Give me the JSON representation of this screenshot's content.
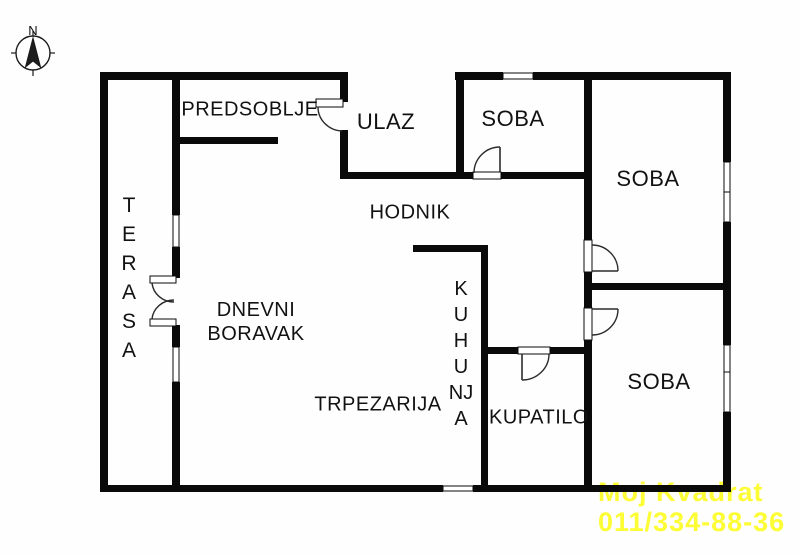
{
  "compass": {
    "north_label": "N"
  },
  "rooms": {
    "predsoblje": "PREDSOBLJE",
    "ulaz": "ULAZ",
    "soba_top": "SOBA",
    "soba_right_upper": "SOBA",
    "soba_right_lower": "SOBA",
    "hodnik": "HODNIK",
    "dnevni_line1": "DNEVNI",
    "dnevni_line2": "BORAVAK",
    "trpezarija": "TRPEZARIJA",
    "kupatilo": "KUPATILO",
    "terasa_letters": [
      "T",
      "E",
      "R",
      "A",
      "S",
      "A"
    ],
    "kuhinja_letters": [
      "K",
      "U",
      "H",
      "U",
      "NJ",
      "A"
    ]
  },
  "watermark": {
    "line1": "Moj Kvadrat",
    "line2": "011/334-88-36",
    "color": "#FDFD35"
  },
  "colors": {
    "wall": "#0a0a0a",
    "background": "#fefefe"
  }
}
